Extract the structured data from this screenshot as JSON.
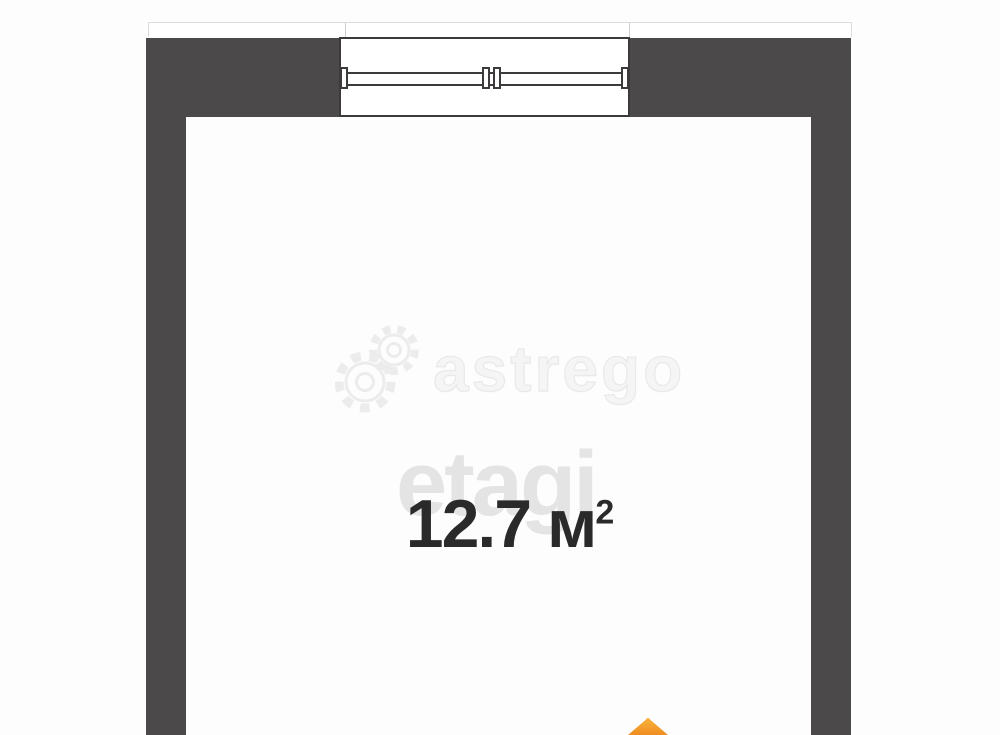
{
  "plan": {
    "area_label": {
      "value": "12.7 м",
      "sup": "2",
      "full": "12.7 м²"
    },
    "watermarks": {
      "astrego": "astrego",
      "etagi": "etagi"
    },
    "window": {
      "panes": 2
    },
    "colors": {
      "wall": "#4b494a",
      "window_line": "#3c3a3b",
      "area_text": "#2a2a2a",
      "watermark_astrego": "#f0f0f0",
      "watermark_etagi": "#e4e4e4",
      "ledge_line": "#dcdcdc",
      "logo_orange_light": "#f7a62f",
      "logo_orange_dark": "#ef8d1f"
    }
  }
}
